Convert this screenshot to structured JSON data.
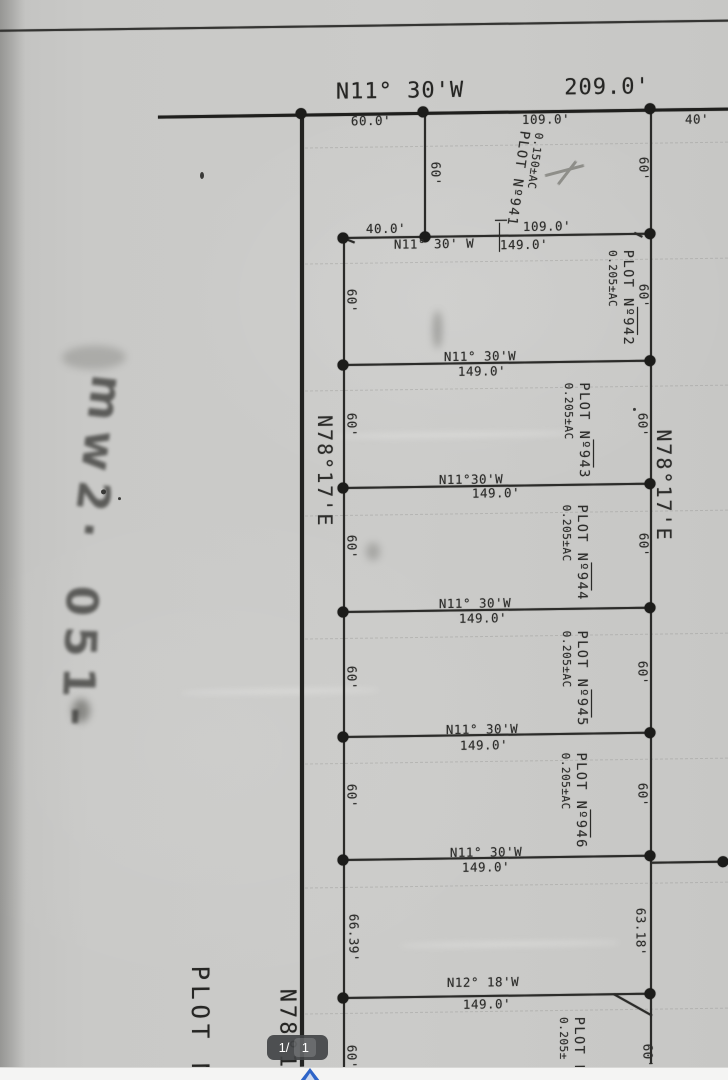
{
  "viewer": {
    "page_badge": {
      "current": "1/",
      "total": "1"
    },
    "scroll_arrow_icon": "chevron-up",
    "colors": {
      "badge_bg": "#434447",
      "arrow_blue": "#2d64c8",
      "page_margin": "#f4f4f3"
    }
  },
  "survey": {
    "colors": {
      "paper": "#c8c8c6",
      "ink": "#2b2b29",
      "pencil": "#8e8e89",
      "marker": "#3a3a37"
    },
    "north": {
      "bearing": "N11° 30'W",
      "distance": "209.0'",
      "seg_left": "60.0'",
      "seg_mid": "109.0'",
      "seg_right": "40'"
    },
    "row1": {
      "seg_left": "40.0'",
      "seg_right": "109.0'"
    },
    "lines": [
      {
        "bearing": "N11° 30' W",
        "distance": "149.0'"
      },
      {
        "bearing": "N11° 30'W",
        "distance": "149.0'"
      },
      {
        "bearing": "N11°30'W",
        "distance": "149.0'"
      },
      {
        "bearing": "N11° 30'W",
        "distance": "149.0'"
      },
      {
        "bearing": "N11° 30'W",
        "distance": "149.0'"
      },
      {
        "bearing": "N11° 30'W",
        "distance": "149.0'"
      }
    ],
    "south": {
      "bearing": "N12° 18'W",
      "distance": "149.0'"
    },
    "plots": [
      {
        "name": "PLOT Nº941",
        "area": "0.150±AC"
      },
      {
        "name": "PLOT Nº942",
        "area": "0.205±AC"
      },
      {
        "name": "PLOT Nº943",
        "area": "0.205±AC"
      },
      {
        "name": "PLOT Nº944",
        "area": "0.205±AC"
      },
      {
        "name": "PLOT Nº945",
        "area": "0.205±AC"
      },
      {
        "name": "PLOT Nº946",
        "area": "0.205±AC"
      },
      {
        "name": "PLOT N",
        "area": "0.205±"
      }
    ],
    "dims": {
      "side": "60'",
      "south_west": "66.39'",
      "south_east": "63.18'"
    },
    "west_road": {
      "bearing": "N78°17'E"
    },
    "east_side": {
      "bearing": "N78°17'E"
    },
    "bottom_left": {
      "plot_label": "PLOT N",
      "bearing": "N78°17'E"
    },
    "annotations": {
      "handwriting_1": "mw2·",
      "handwriting_2": "051-",
      "pencil_mark": "x-cross"
    }
  }
}
